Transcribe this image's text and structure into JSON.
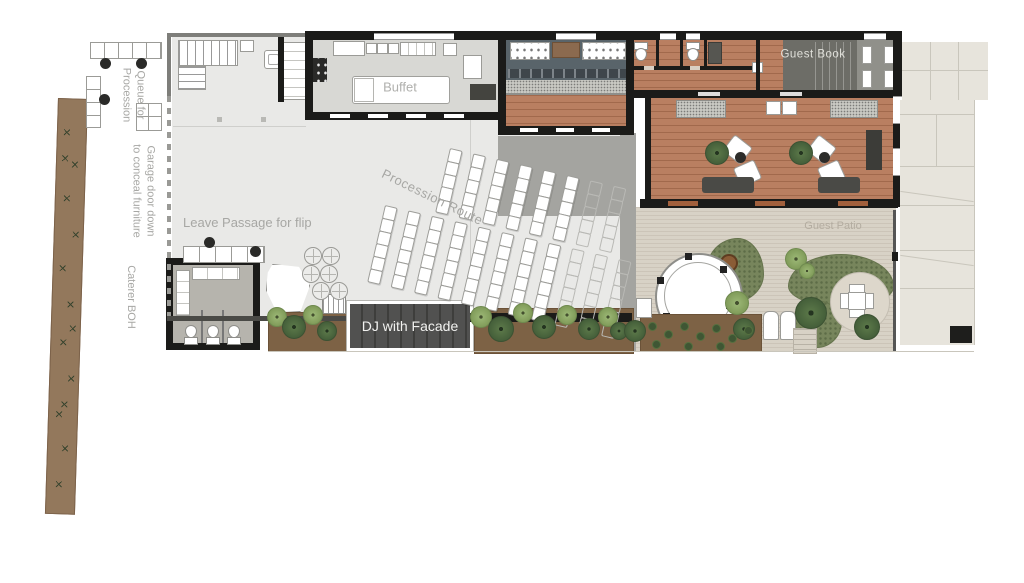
{
  "labels": {
    "queue_line1": "Queue for",
    "queue_line2": "Procession",
    "garage_line1": "Garage door down",
    "garage_line2": "to conceal furniture",
    "caterer": "Caterer BOH",
    "passage": "Leave Passage for flip",
    "buffet": "Buffet",
    "procession": "Procession Route",
    "guest_book": "Guest Book",
    "dj": "DJ with Facade",
    "guest_patio": "Guest Patio"
  },
  "colors": {
    "wall": "#1b1b19",
    "hall": "#e9e9e7",
    "hallline": "#cfcfcc",
    "kitchen": "#d8d8d4",
    "bar": "#59646a",
    "wood": "#b97f61",
    "grayzone": "#a4a4a0",
    "paving": "#d8d2c6",
    "sidewalk": "#e7e4dc",
    "joint": "#c9c6bc",
    "lawn": "#77855c",
    "lawndot": "#5d6c47",
    "soil": "#7d6245",
    "strip": "#93785c",
    "stage": "#515150",
    "stagedark": "#3e3e3c",
    "label": "#a7a7a4",
    "furnline": "#9b9b97",
    "darkfurn": "#4a4a46",
    "terracotta": "#a2603c",
    "gbstair": "#6d6d67",
    "vestibule": "#90908a",
    "speckle": "#c9c9c3"
  },
  "seating": {
    "blocks": [
      {
        "x": 450,
        "y": 148,
        "angle": 13,
        "cols": 8,
        "rows": 5,
        "chair_w": 11,
        "chair_h": 12,
        "col_gap": 24,
        "ghost_cols": 2
      },
      {
        "x": 385,
        "y": 205,
        "angle": 13,
        "cols": 11,
        "rows": 6,
        "chair_w": 11,
        "chair_h": 12,
        "col_gap": 24,
        "ghost_cols": 3
      }
    ]
  },
  "cocktail_tables": [
    [
      304,
      247
    ],
    [
      322,
      247
    ],
    [
      302,
      265
    ],
    [
      320,
      265
    ],
    [
      312,
      282
    ],
    [
      330,
      282
    ]
  ],
  "flora": {
    "dj_left_plants": [
      [
        276,
        316,
        9,
        "light"
      ],
      [
        293,
        326,
        11,
        "dark"
      ],
      [
        312,
        314,
        9,
        "light"
      ],
      [
        326,
        330,
        9,
        "dark"
      ]
    ],
    "dj_right_plants": [
      [
        480,
        316,
        10,
        "light"
      ],
      [
        500,
        328,
        12,
        "dark"
      ],
      [
        522,
        312,
        9,
        "light"
      ],
      [
        543,
        326,
        11,
        "dark"
      ],
      [
        566,
        314,
        9,
        "light"
      ],
      [
        588,
        328,
        10,
        "dark"
      ],
      [
        607,
        316,
        9,
        "light"
      ],
      [
        618,
        330,
        8,
        "dark"
      ]
    ],
    "garden_trees": [
      [
        736,
        302,
        11,
        "light"
      ],
      [
        743,
        328,
        10,
        "dark"
      ],
      [
        810,
        312,
        15,
        "dark"
      ],
      [
        866,
        326,
        12,
        "dark"
      ],
      [
        634,
        330,
        10,
        "dark"
      ],
      [
        795,
        258,
        10,
        "light"
      ],
      [
        806,
        270,
        7,
        "light"
      ]
    ],
    "lounge_plants": [
      [
        716,
        152,
        11,
        "dark"
      ],
      [
        800,
        152,
        11,
        "dark"
      ]
    ],
    "bed_shrubs": [
      [
        648,
        322
      ],
      [
        664,
        330
      ],
      [
        680,
        322
      ],
      [
        696,
        332
      ],
      [
        712,
        324
      ],
      [
        728,
        334
      ],
      [
        744,
        326
      ],
      [
        652,
        340
      ],
      [
        684,
        342
      ],
      [
        716,
        342
      ]
    ],
    "strip_sprigs": [
      [
        6,
        30
      ],
      [
        15,
        62
      ],
      [
        8,
        96
      ],
      [
        18,
        132
      ],
      [
        6,
        166
      ],
      [
        15,
        202
      ],
      [
        9,
        240
      ],
      [
        18,
        276
      ],
      [
        7,
        312
      ],
      [
        14,
        346
      ],
      [
        9,
        382
      ],
      [
        5,
        56
      ],
      [
        18,
        226
      ],
      [
        12,
        302
      ]
    ]
  },
  "gazebo": {
    "posts": [
      [
        726,
        302
      ],
      [
        698,
        326
      ],
      [
        663,
        313
      ],
      [
        657,
        277
      ],
      [
        685,
        253
      ],
      [
        720,
        266
      ]
    ]
  }
}
